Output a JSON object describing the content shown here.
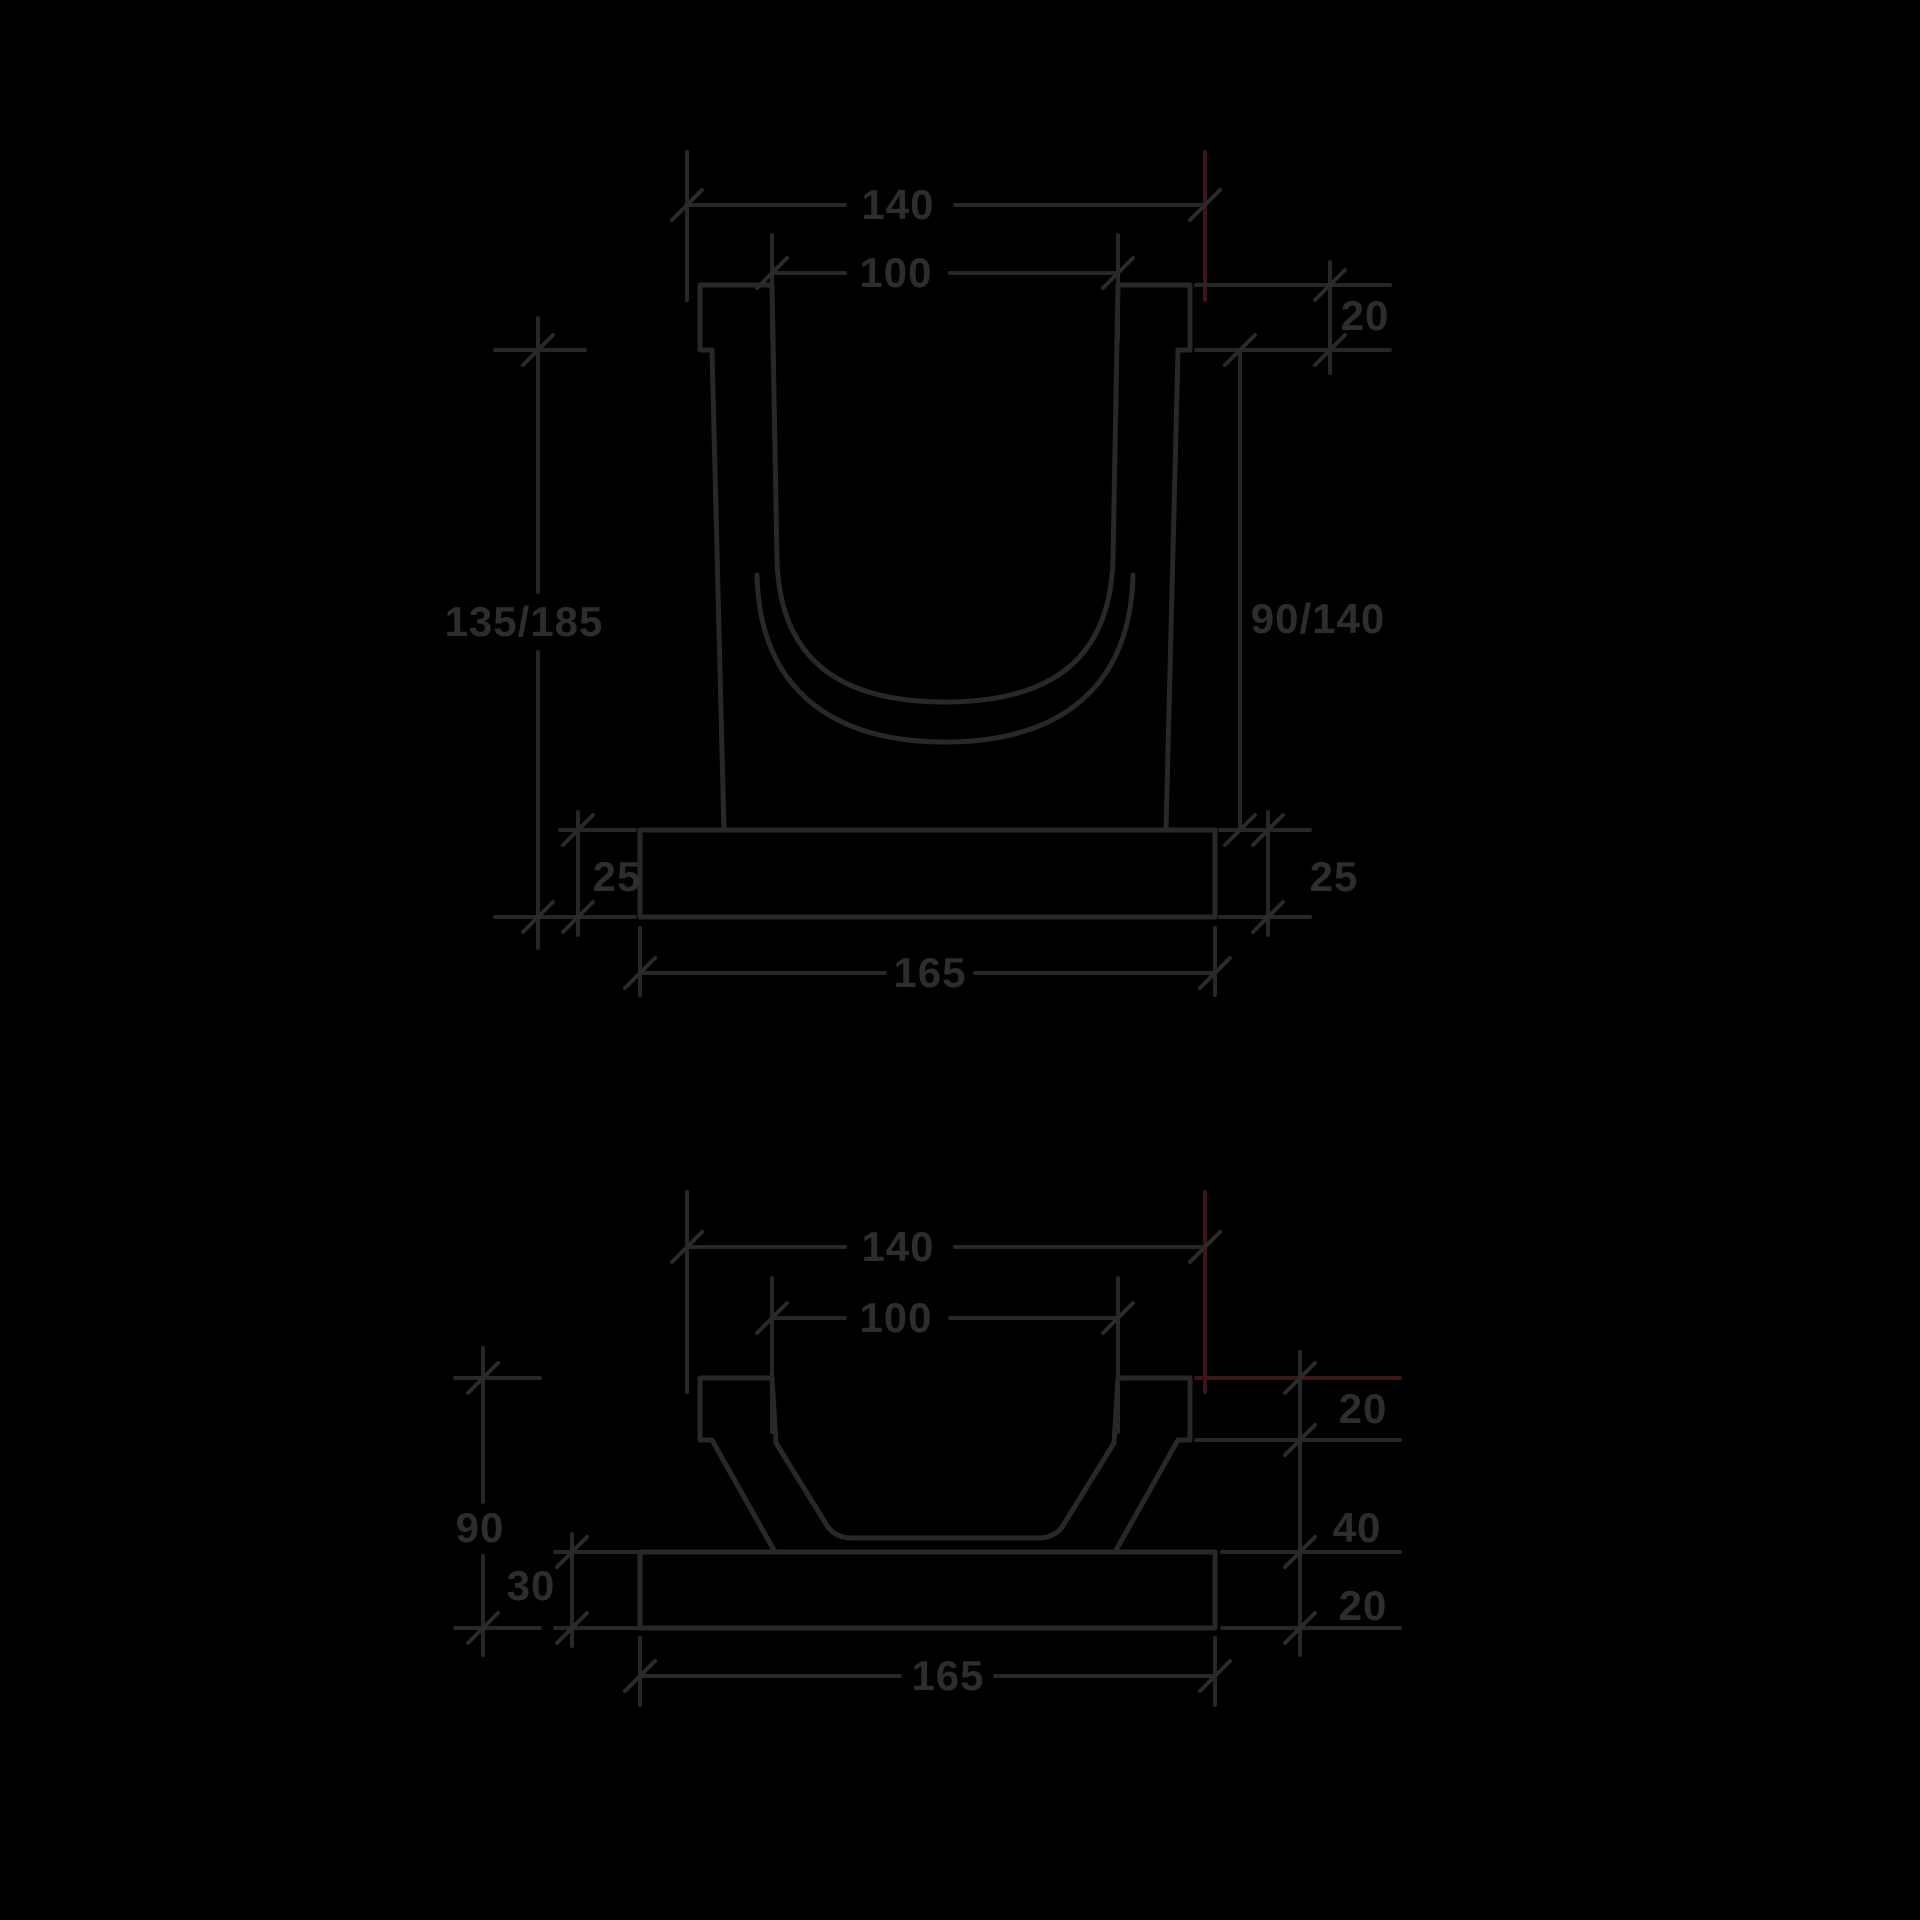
{
  "page": {
    "background_color": "#000000",
    "line_color": "#282828",
    "artifact_red_color": "#3b1617",
    "text_color": "#2d2d2d"
  },
  "drawings": {
    "top": {
      "name": "deep-channel-cross-section",
      "dims": {
        "overall_width": "140",
        "inner_width": "100",
        "rim_height": "20",
        "overall_height": "135/185",
        "inner_depth": "90/140",
        "base_thickness_left": "25",
        "base_thickness_right": "25",
        "base_width": "165"
      }
    },
    "bottom": {
      "name": "shallow-channel-cross-section",
      "dims": {
        "overall_width": "140",
        "inner_width": "100",
        "rim_height": "20",
        "overall_height": "90",
        "inner_depth": "40",
        "base_thickness_left": "30",
        "base_thickness_right": "20",
        "base_width": "165"
      }
    }
  }
}
